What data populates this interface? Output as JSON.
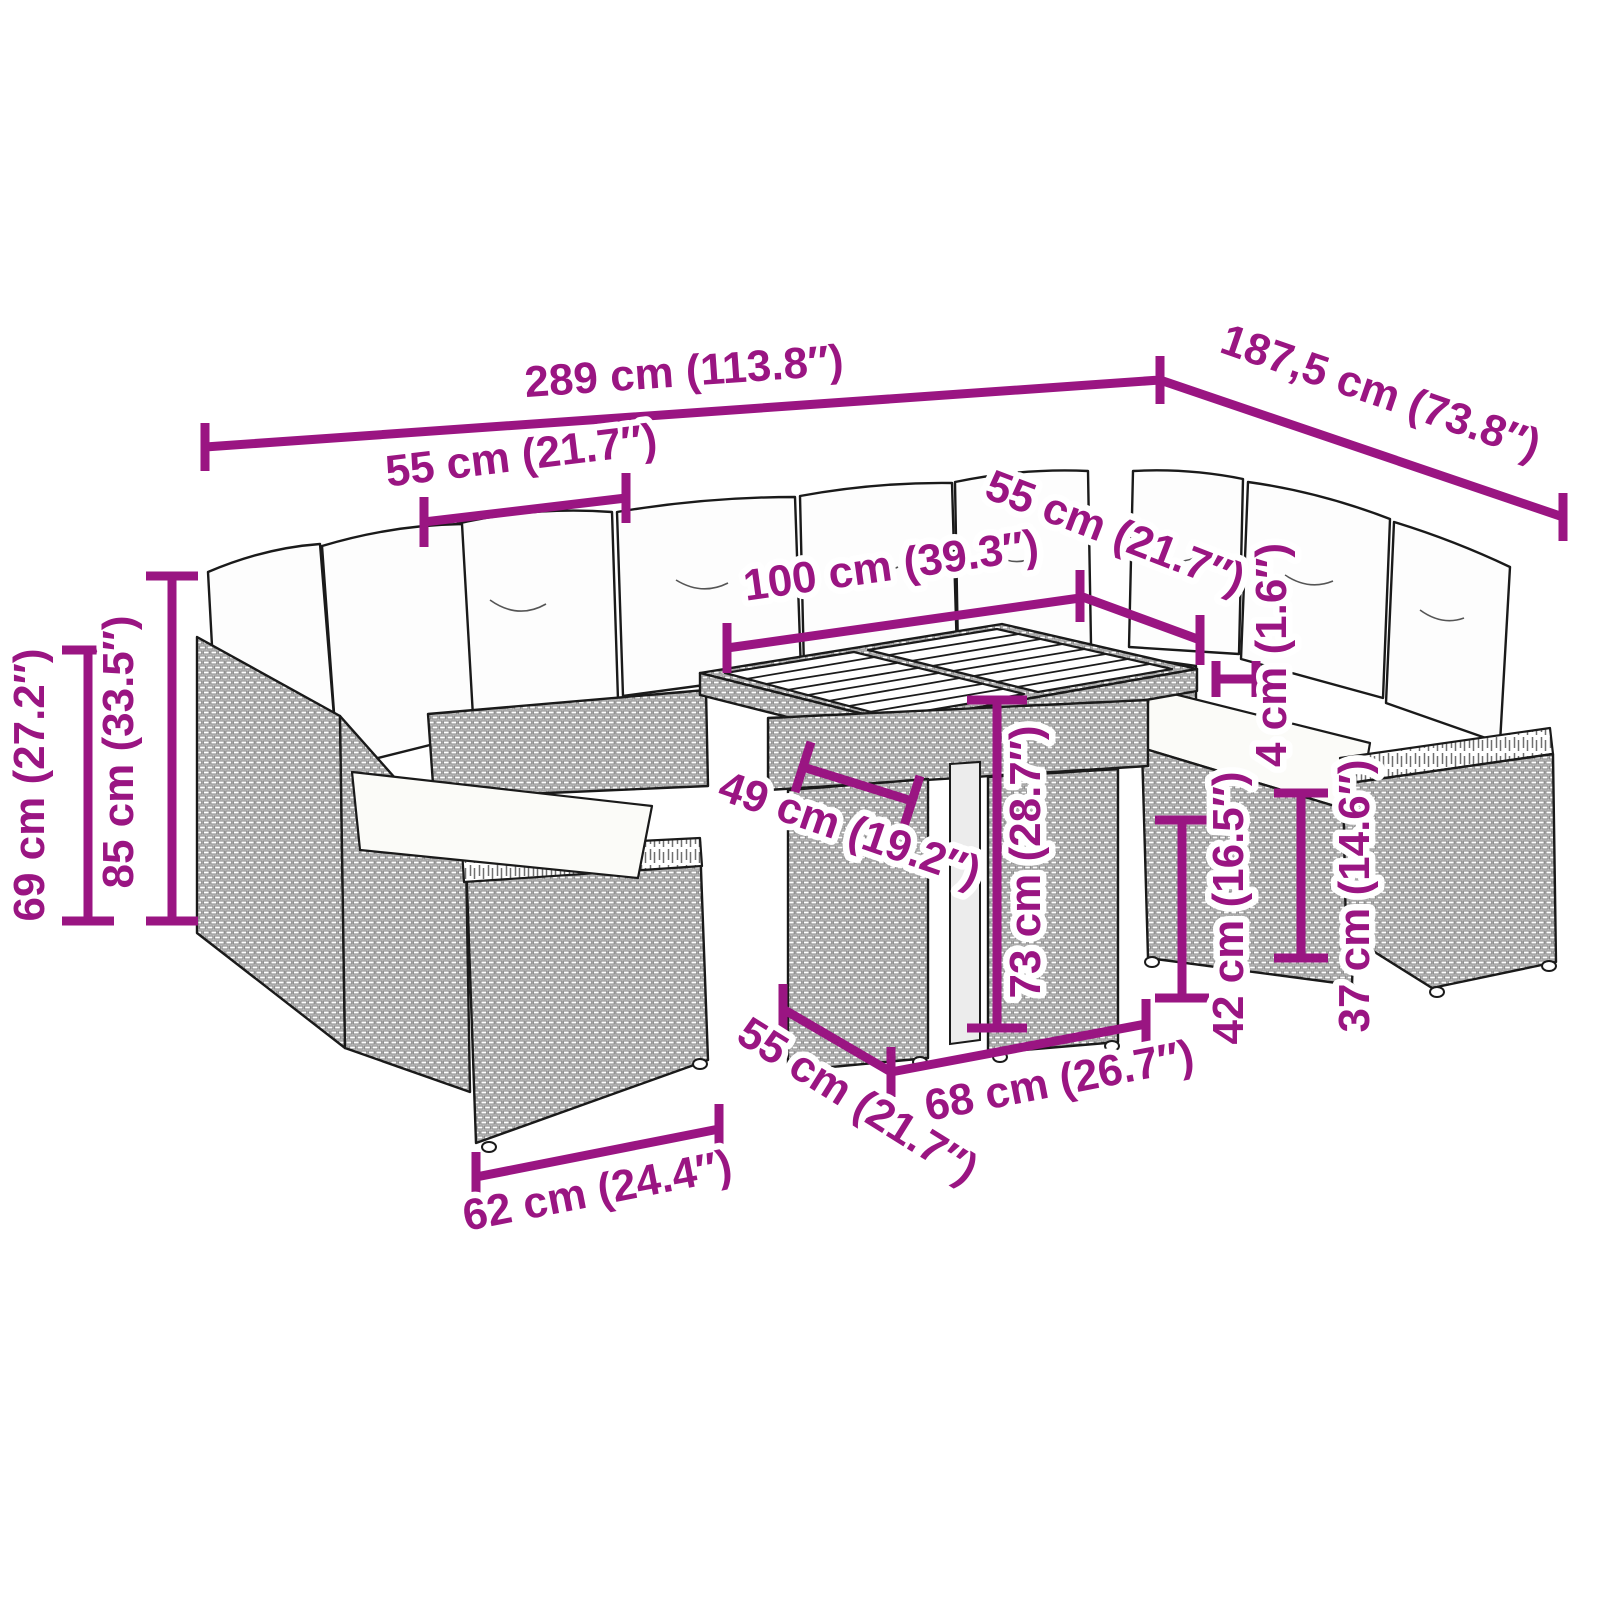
{
  "figure": {
    "kind": "product-dimension-diagram",
    "subject": "modular-garden-lounge-set-with-table"
  },
  "colors": {
    "dimension_accent": "#9A1582",
    "line_art": "#1A1A1A",
    "background": "#FFFFFF"
  },
  "dims": [
    {
      "id": "overall-width",
      "label": "289 cm (113.8″)"
    },
    {
      "id": "overall-depth",
      "label": "187,5 cm (73.8″)"
    },
    {
      "id": "seat-width-top",
      "label": "55 cm (21.7″)"
    },
    {
      "id": "table-length",
      "label": "100 cm (39.3″)"
    },
    {
      "id": "seat-width-right",
      "label": "55 cm (21.7″)"
    },
    {
      "id": "tabletop-thickness",
      "label": "4 cm (1.6″)"
    },
    {
      "id": "back-height",
      "label": "69 cm (27.2″)"
    },
    {
      "id": "total-height",
      "label": "85 cm (33.5″)"
    },
    {
      "id": "table-inner-width",
      "label": "49 cm (19.2″)"
    },
    {
      "id": "table-height",
      "label": "73 cm (28.7″)"
    },
    {
      "id": "seat-depth-bottom",
      "label": "55 cm (21.7″)"
    },
    {
      "id": "table-base-width",
      "label": "68 cm (26.7″)"
    },
    {
      "id": "seat-height",
      "label": "42 cm (16.5″)"
    },
    {
      "id": "arm-height",
      "label": "37 cm (14.6″)"
    },
    {
      "id": "module-width",
      "label": "62 cm (24.4″)"
    }
  ]
}
